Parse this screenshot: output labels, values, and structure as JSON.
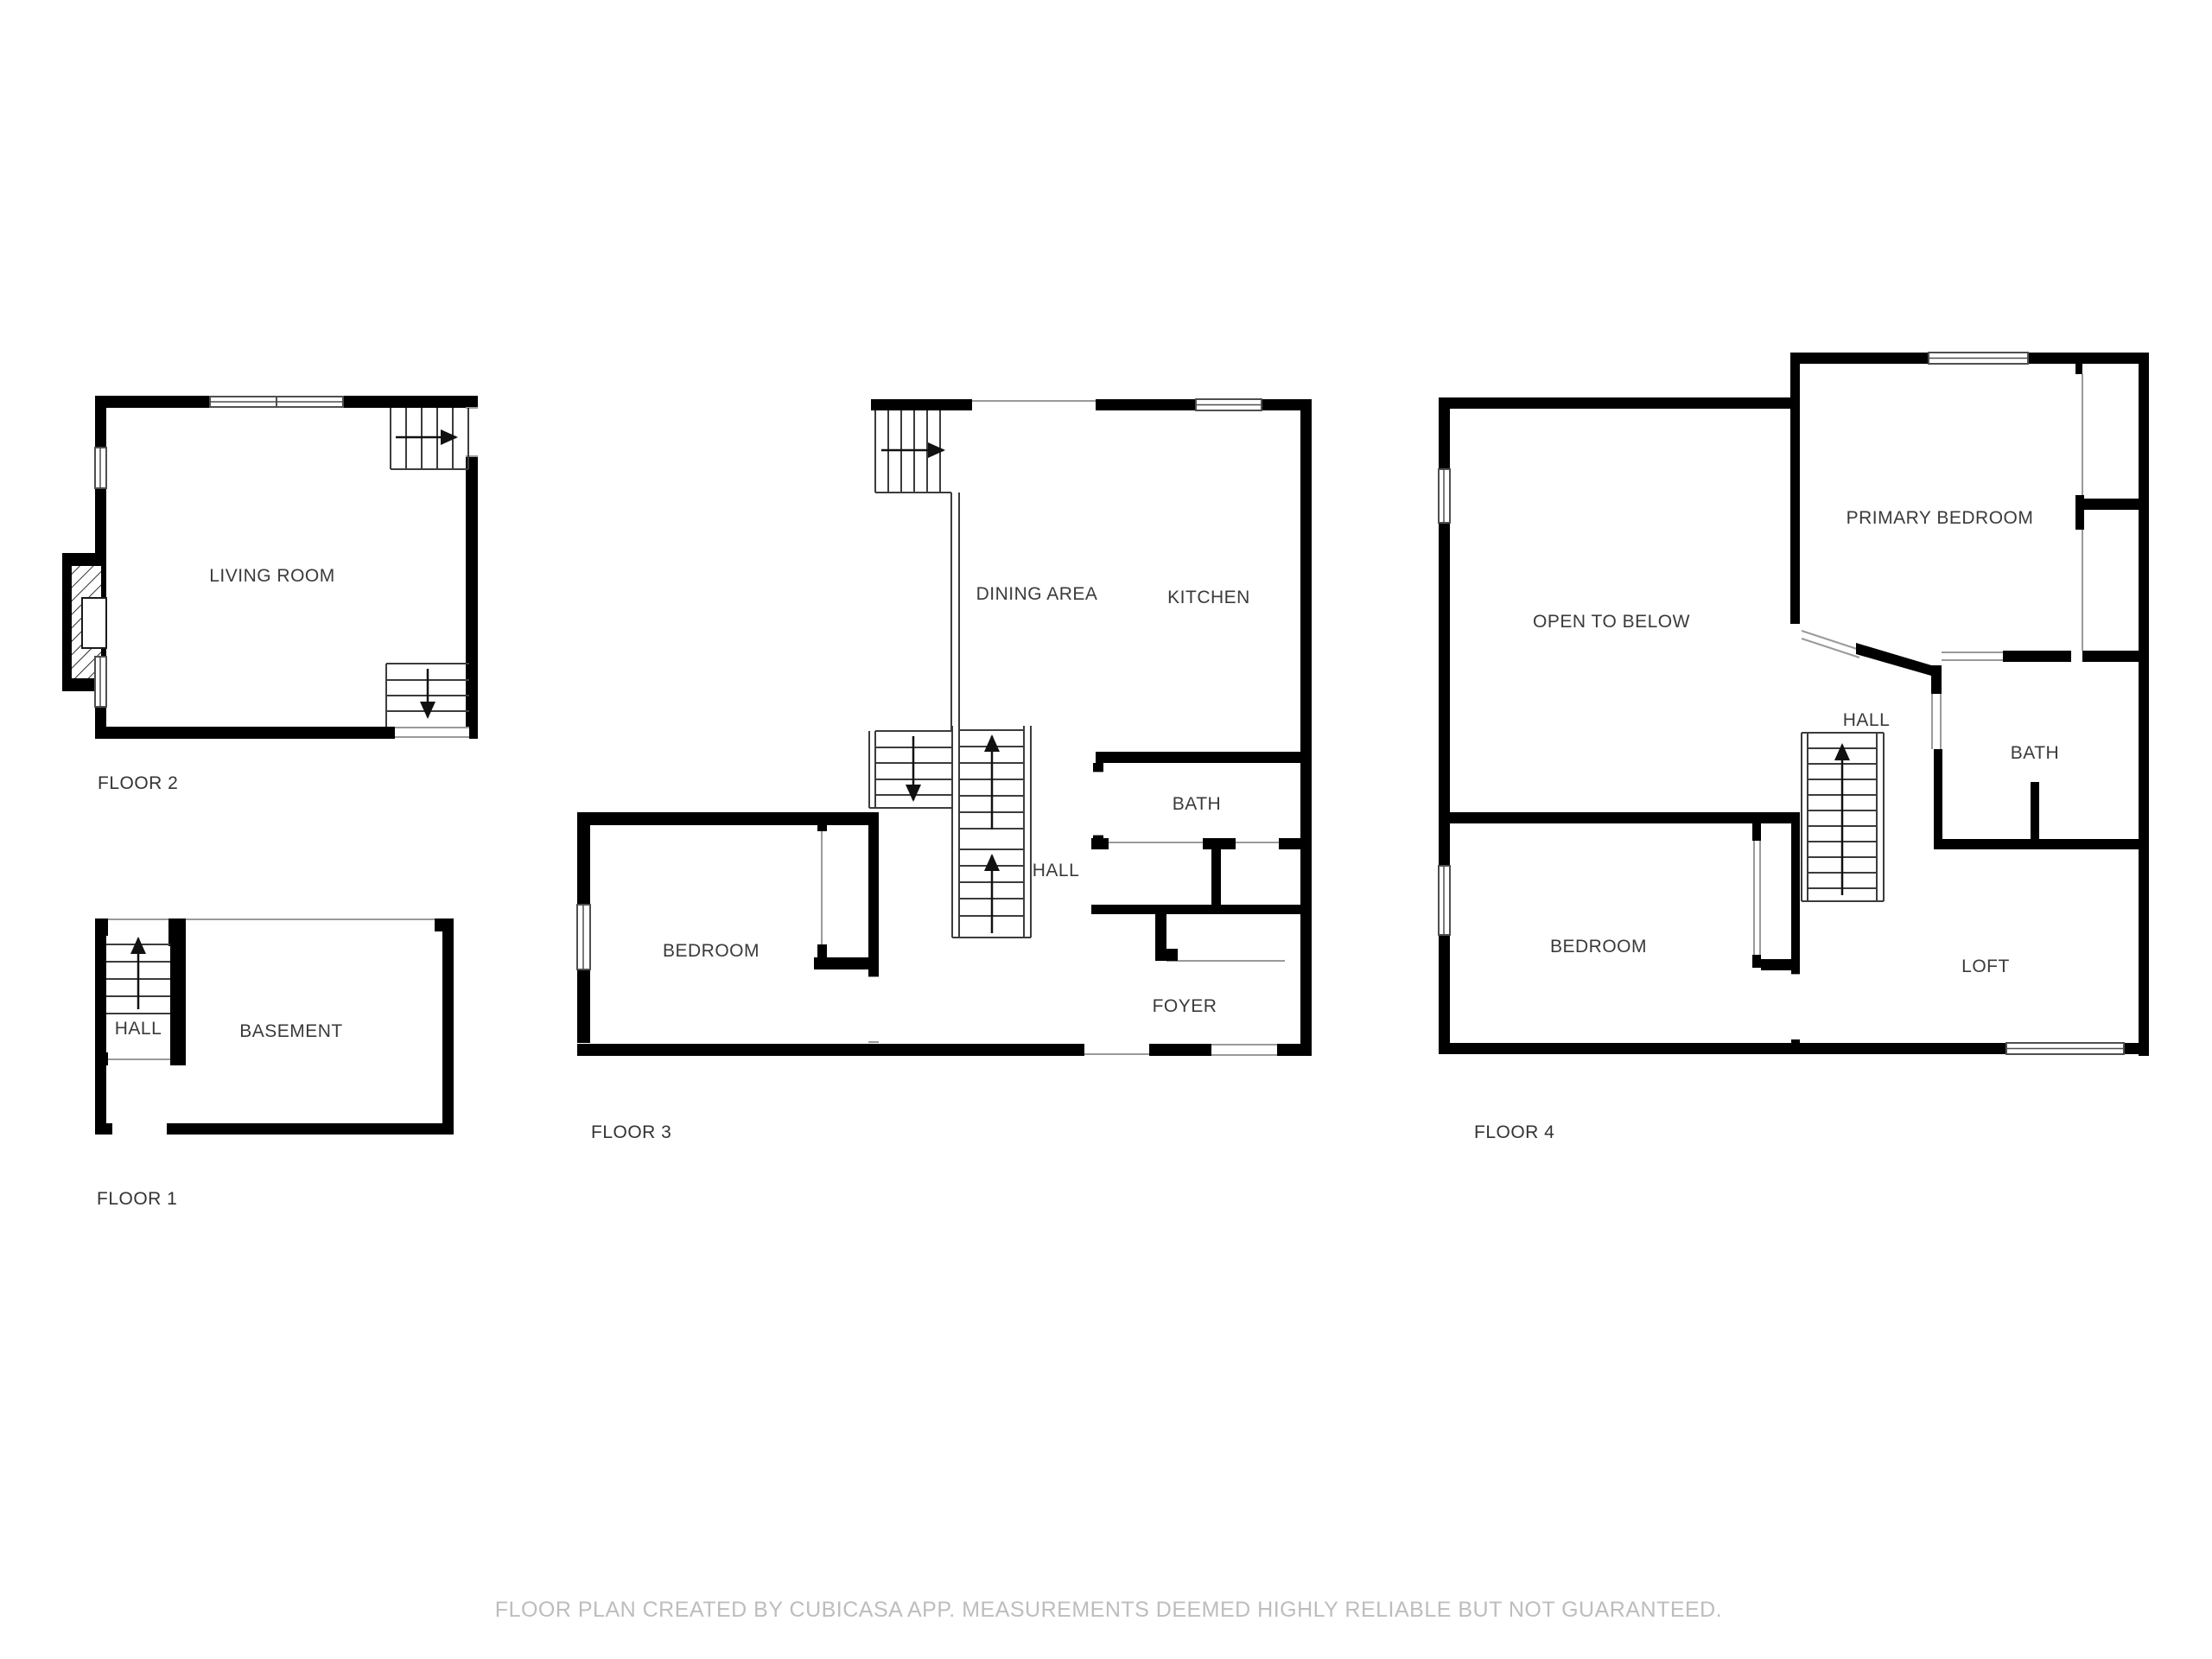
{
  "page": {
    "background": "#ffffff",
    "disclaimer": "FLOOR PLAN CREATED BY CUBICASA APP. MEASUREMENTS DEEMED HIGHLY RELIABLE BUT NOT GUARANTEED."
  },
  "colors": {
    "wall": "#000000",
    "opening_line": "#9a9a9a",
    "stair_line": "#3c3c3c",
    "room_label": "#3a3a3a",
    "floor_label": "#333333",
    "disclaimer_text": "#bdbdbd"
  },
  "floors": [
    {
      "id": "floor-1",
      "label": "FLOOR 1",
      "rooms": [
        {
          "name": "hall",
          "label": "HALL"
        },
        {
          "name": "basement",
          "label": "BASEMENT"
        }
      ]
    },
    {
      "id": "floor-2",
      "label": "FLOOR 2",
      "rooms": [
        {
          "name": "living-room",
          "label": "LIVING ROOM"
        }
      ]
    },
    {
      "id": "floor-3",
      "label": "FLOOR 3",
      "rooms": [
        {
          "name": "dining-area",
          "label": "DINING AREA"
        },
        {
          "name": "kitchen",
          "label": "KITCHEN"
        },
        {
          "name": "bath",
          "label": "BATH"
        },
        {
          "name": "hall",
          "label": "HALL"
        },
        {
          "name": "bedroom",
          "label": "BEDROOM"
        },
        {
          "name": "foyer",
          "label": "FOYER"
        }
      ]
    },
    {
      "id": "floor-4",
      "label": "FLOOR 4",
      "rooms": [
        {
          "name": "open-to-below",
          "label": "OPEN TO BELOW"
        },
        {
          "name": "primary-bedroom",
          "label": "PRIMARY BEDROOM"
        },
        {
          "name": "hall",
          "label": "HALL"
        },
        {
          "name": "bath",
          "label": "BATH"
        },
        {
          "name": "bedroom",
          "label": "BEDROOM"
        },
        {
          "name": "loft",
          "label": "LOFT"
        }
      ]
    }
  ]
}
